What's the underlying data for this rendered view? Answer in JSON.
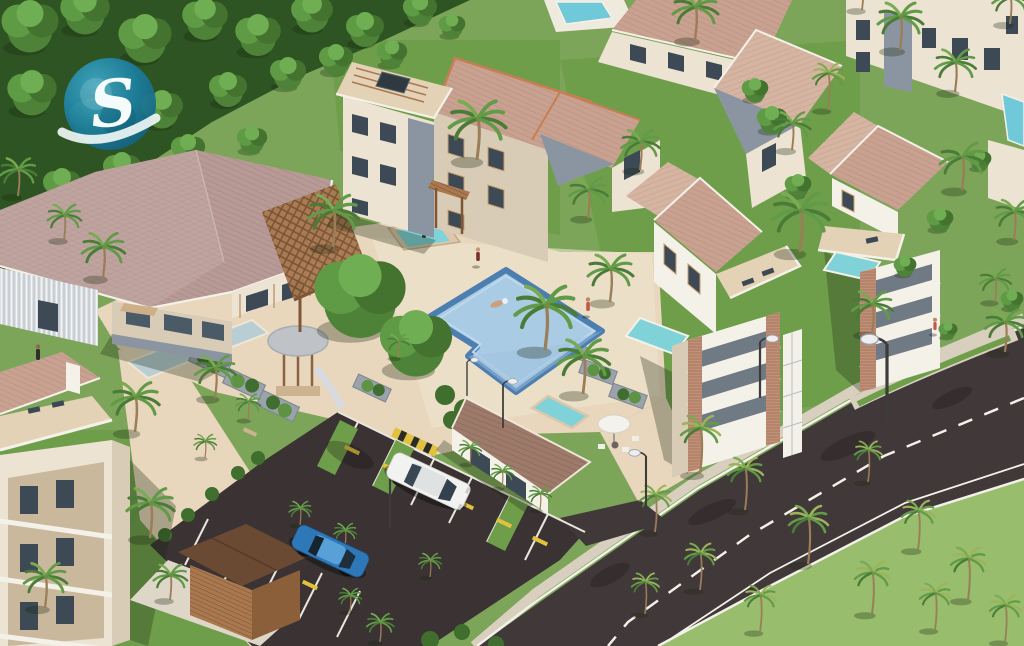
{
  "scene": {
    "type": "3d-architectural-aerial-rendering",
    "description": "Aerial isometric rendering of a tropical resort residential complex: clubhouse with large mauve hip roof, three-story apartment building, swimming pool with swimmer, villas and towers with rooftop plunge pools, angled parking lot with two sedans, diagonal palm-lined road, dense forest at top-left with circular teal logo watermark",
    "setting": "tropical-resort-community"
  },
  "logo": {
    "letter": "S",
    "shape": "circular-watermark",
    "color": "#1c7fa0"
  },
  "objects": {
    "buildings": [
      {
        "name": "clubhouse",
        "roof": "mauve-hip",
        "features": [
          "wood-pergola",
          "storefront-openings",
          "striped-curtain-wall"
        ]
      },
      {
        "name": "central-apartment-building",
        "floors": 3,
        "features": [
          "rooftop-terrace-pergola",
          "solar-panel",
          "gray-accent-panels",
          "hip-roof-orange-ridge"
        ]
      },
      {
        "name": "north-building",
        "features": [
          "rooftop-pool"
        ]
      },
      {
        "name": "north-east-corner-building",
        "features": [
          "gray-accent-panel",
          "rooftop-pool"
        ]
      },
      {
        "name": "east-villa",
        "features": [
          "rooftop-terrace",
          "plunge-pool",
          "loungers"
        ]
      },
      {
        "name": "east-apartment-tower",
        "features": [
          "balconies",
          "brick-columns",
          "rooftop-plunge-pool",
          "white-umbrella"
        ]
      },
      {
        "name": "far-east-building",
        "features": [
          "balconies",
          "rooftop-plunge-pool"
        ]
      },
      {
        "name": "south-west-apartment-building",
        "features": [
          "balconies",
          "rooftop-terrace",
          "plunge-pool"
        ]
      },
      {
        "name": "pool-house",
        "features": [
          "hip-roof",
          "spa"
        ]
      },
      {
        "name": "wooden-shed"
      }
    ],
    "amenities": [
      "swimming-pool",
      "raised-spa",
      "gazebo-with-slide",
      "garden-planters",
      "water-features",
      "parking-lot",
      "benches"
    ],
    "vehicles": [
      {
        "type": "sedan",
        "color": "white",
        "location": "parking-stall-center"
      },
      {
        "type": "sedan",
        "color": "blue",
        "location": "parking-stall-lower-left"
      }
    ],
    "people": [
      {
        "where": "swimming-in-pool"
      },
      {
        "where": "walking-on-pool-deck"
      },
      {
        "where": "standing-on-lawn-east-of-pool"
      },
      {
        "where": "at-clubhouse-entrance"
      },
      {
        "where": "walking-on-east-lawn"
      }
    ],
    "vegetation": {
      "palm_trees": 50,
      "round_courtyard_trees": 2,
      "forest": "dense-top-left",
      "royal_palms": "bottom-right-lawn"
    },
    "roads": {
      "main_road": "diagonal-bottom-right",
      "markings": [
        "dashed-white-centerline",
        "solid-white-edge-lines",
        "sidewalk"
      ],
      "parking": "angled-stalls-with-grass-strips-and-yellow-wheel-stops",
      "speed_bump": "yellow-black-striped",
      "street_lamps": 6
    }
  },
  "palette": {
    "grass_base": "#7da55a",
    "grass_light": "#97bd6d",
    "grass_mid": "#6f9e4b",
    "forest": "#2d5422",
    "hedge": "#3f6e2e",
    "plaza": "#e8d6bd",
    "path": "#efe4cf",
    "deck_tan": "#e3d2b6",
    "roof_mauve": "#b79a96",
    "roof_mauve_lt": "#c6aca6",
    "roof_pink": "#c9a191",
    "roof_pink_lt": "#d6b4a2",
    "roof_brown": "#9d7a6a",
    "ridge": "#c67e52",
    "wall_cream": "#ece3d2",
    "wall_shade": "#d9ccb6",
    "wall_white": "#f4f1e9",
    "wall_gray": "#8b95a1",
    "wood": "#a9784f",
    "wood_dark": "#7e5635",
    "brick": "#b5846a",
    "window": "#3d4a55",
    "glass": "#4a5a66",
    "pool": "#a9cbe4",
    "pool_rim": "#4c7eb0",
    "spa": "#7fd2d8",
    "rooftop_pool": "#6fc9d9",
    "asphalt": "#413839",
    "parking": "#3a3233",
    "line_white": "#f2f0e8",
    "curb": "#d8cfbf",
    "stop_yellow": "#e0c23f",
    "car_white": "#f2f2f0",
    "car_blue": "#2f78b8",
    "planter": "#9aa2ab",
    "canopy": "#bfc3c7",
    "trunk": "#9b7d58",
    "palm_dark": "#4a7c38",
    "palm_mid": "#629b48",
    "palm_lt": "#79ab52",
    "palm_yel": "#9db35a",
    "logo_teal": "#1c7fa0",
    "logo_teal_lt": "#3fa9c4",
    "logo_teal_dk": "#135f7e",
    "shadow_c": "rgba(25,40,18,0.30)"
  }
}
